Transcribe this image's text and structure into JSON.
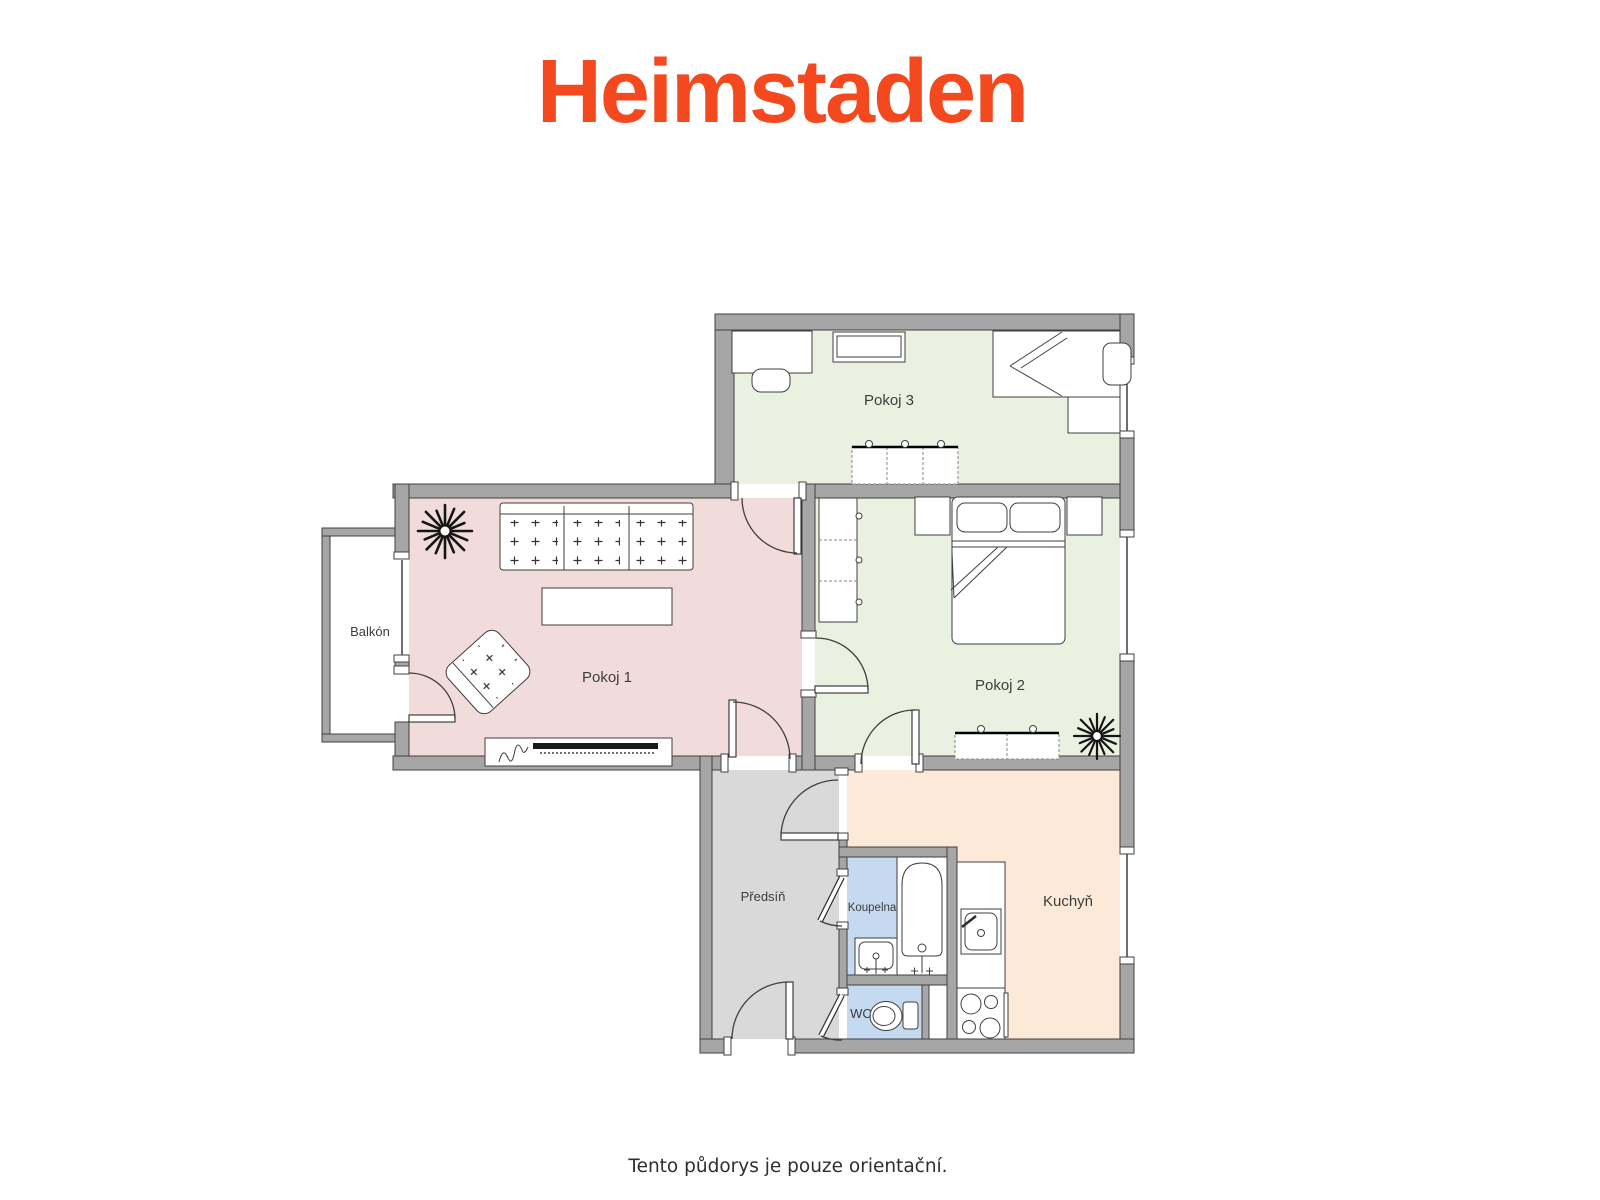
{
  "brand": {
    "logo_text": "Heimstaden",
    "logo_color": "#F4481F"
  },
  "footer": {
    "disclaimer": "Tento půdorys je pouze orientační."
  },
  "floor_plan": {
    "wall_color": "#A6A6A6",
    "rooms": [
      {
        "id": "pokoj1",
        "label": "Pokoj 1",
        "fill": "#F2DCDB"
      },
      {
        "id": "pokoj2",
        "label": "Pokoj 2",
        "fill": "#EBF1E0"
      },
      {
        "id": "pokoj3",
        "label": "Pokoj 3",
        "fill": "#EBF1E0"
      },
      {
        "id": "balkon",
        "label": "Balkón",
        "fill": "#FFFFFF"
      },
      {
        "id": "predsin",
        "label": "Předsíň",
        "fill": "#D9D9D9"
      },
      {
        "id": "koupelna",
        "label": "Koupelna",
        "fill": "#C5D9F0"
      },
      {
        "id": "wc",
        "label": "WC",
        "fill": "#C5D9F0"
      },
      {
        "id": "kuchyn",
        "label": "Kuchyň",
        "fill": "#FCE9D8"
      }
    ]
  }
}
